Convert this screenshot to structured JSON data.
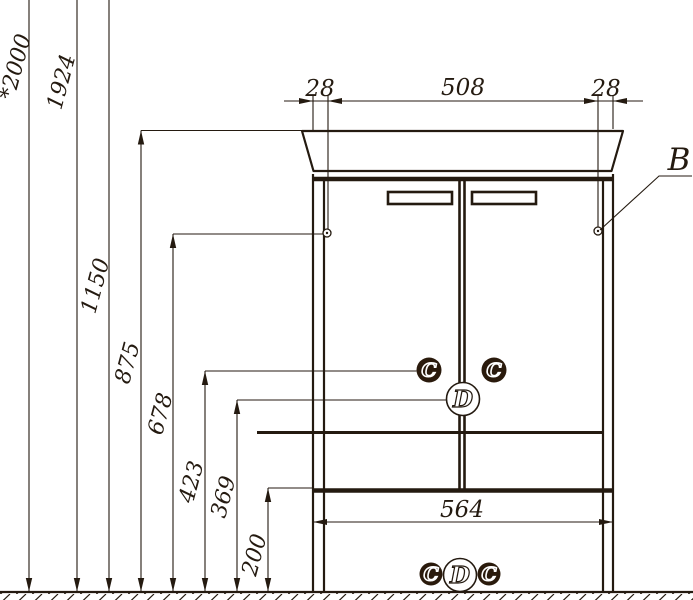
{
  "colors": {
    "ink": "#241a10",
    "marker": "#2a1a0c",
    "paper": "#ffffff"
  },
  "height_dims": [
    "*2000",
    "1924",
    "1150",
    "875",
    "678",
    "423",
    "369",
    "200"
  ],
  "top_dims": [
    "28",
    "508",
    "28"
  ],
  "bottom_dim": "564",
  "callout_b": "B",
  "mid_markers": [
    "C",
    "C",
    "D"
  ],
  "bottom_markers": [
    "C",
    "D",
    "C"
  ]
}
